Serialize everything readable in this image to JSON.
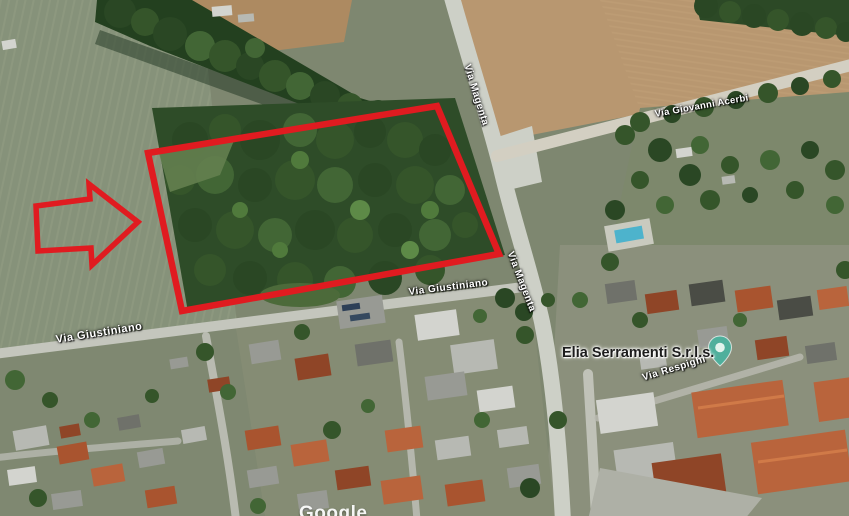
{
  "page": {
    "kind": "satellite-map-screenshot"
  },
  "annotation": {
    "color": "#e01b20",
    "shapes": [
      "highlighted-parcel-rectangle",
      "pointer-arrow"
    ]
  },
  "map_labels": [
    {
      "id": "via-magenta-upper",
      "text": "Via Magenta"
    },
    {
      "id": "via-giovanni-acerbi",
      "text": "Via Giovanni Acerbi"
    },
    {
      "id": "via-magenta-lower",
      "text": "Via Magenta"
    },
    {
      "id": "via-giustiniano-center",
      "text": "Via Giustiniano"
    },
    {
      "id": "via-giustiniano-left",
      "text": "Via Giustiniano"
    },
    {
      "id": "via-respighi",
      "text": "Via Respighi"
    }
  ],
  "business": {
    "name": "Elia Serramenti S.r.l.s.",
    "pin_color": "#4faf9c",
    "pin_inner_color": "#e2f3ed"
  },
  "watermark": {
    "text": "Google"
  }
}
